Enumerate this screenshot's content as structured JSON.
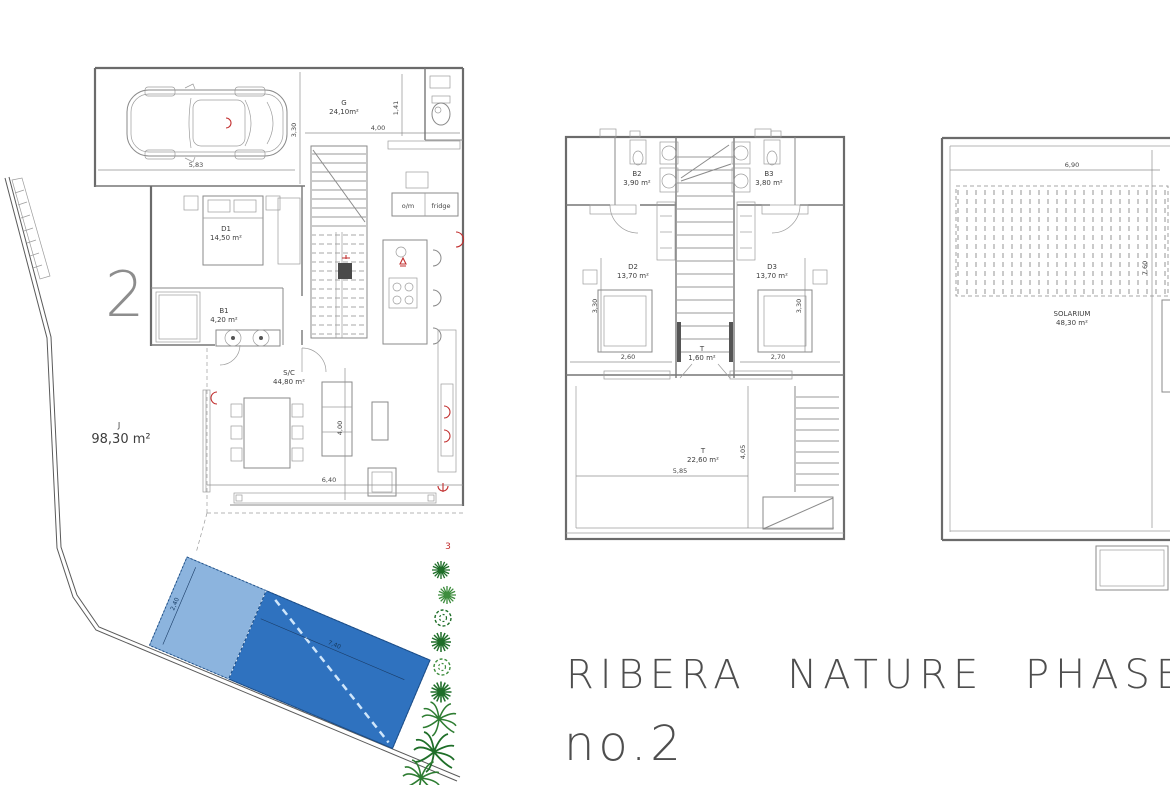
{
  "title": {
    "line1": "RIBERA NATURE PHASE",
    "line2": "no.2"
  },
  "colors": {
    "pool_dark": "#2f72bf",
    "pool_light": "#8cb4de",
    "plant_green_dark": "#1e6e28",
    "plant_green_mid": "#3e8d3e",
    "accent_red": "#c22f2f",
    "line_gray": "#6b6b6b",
    "title_gray": "#4e4e4e"
  },
  "ground_floor": {
    "plot_number": "2",
    "garage_label": "G",
    "garage_area": "24,10m²",
    "dim_garage_width": "5,83",
    "dim_garage_depth": "3,30",
    "dim_kitchen_width": "4,00",
    "dim_wc_width": "1,41",
    "bedroom_label": "D1",
    "bedroom_area": "14,50 m²",
    "bath_label": "B1",
    "bath_area": "4,20 m²",
    "living_label": "S/C",
    "living_area": "44,80 m²",
    "dim_living_width": "6,40",
    "dim_living_depth": "4,00",
    "garden_label": "J",
    "garden_area": "98,30 m²",
    "appliance_oven": "o/m",
    "appliance_fridge": "fridge",
    "pool_dim_length": "7,40",
    "pool_dim_width": "2,40",
    "neighbor_plot_number": "3"
  },
  "first_floor": {
    "bath2_label": "B2",
    "bath2_area": "3,90 m²",
    "bath3_label": "B3",
    "bath3_area": "3,80 m²",
    "bedroom2_label": "D2",
    "bedroom2_area": "13,70 m²",
    "bedroom3_label": "D3",
    "bedroom3_area": "13,70 m²",
    "dim_bedroom2_width": "2,60",
    "dim_bedroom3_width": "2,70",
    "dim_bedroom2_depth": "3,30",
    "dim_bedroom3_depth": "3,30",
    "landing_label": "T",
    "landing_area": "1,60 m²",
    "terrace_label": "T",
    "terrace_area": "22,60 m²",
    "dim_terrace_width": "5,85",
    "dim_terrace_depth": "4,05"
  },
  "roof": {
    "solarium_label": "SOLARIUM",
    "solarium_area": "48,30 m²",
    "dim_width": "6,90",
    "dim_depth": "7,60"
  }
}
